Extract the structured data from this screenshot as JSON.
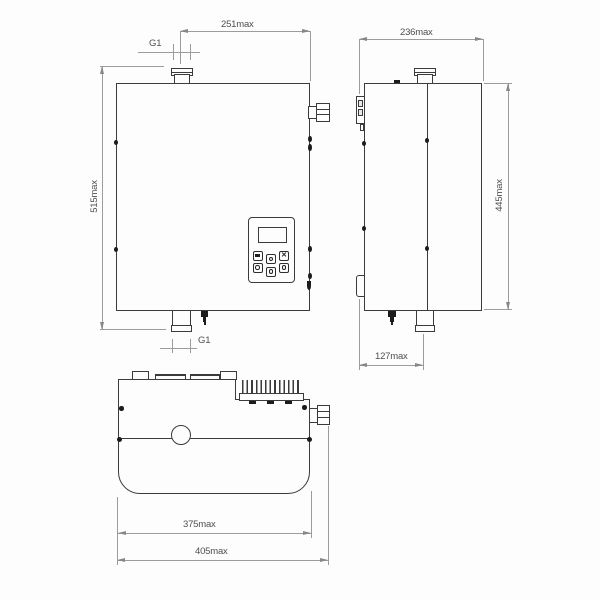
{
  "drawing": {
    "front_view": {
      "height_label": "515max",
      "top_width_label": "251max",
      "port_top_label": "G1",
      "port_bottom_label": "G1"
    },
    "side_view": {
      "depth_label": "236max",
      "height_label": "445max",
      "pipe_offset_label": "127max"
    },
    "top_view": {
      "body_width_label": "375max",
      "total_width_label": "405max"
    },
    "colors": {
      "outline": "#3b3b3b",
      "dimension_line": "#9c9c9c",
      "text": "#4f4f4f",
      "background": "#fdfdfd"
    }
  }
}
